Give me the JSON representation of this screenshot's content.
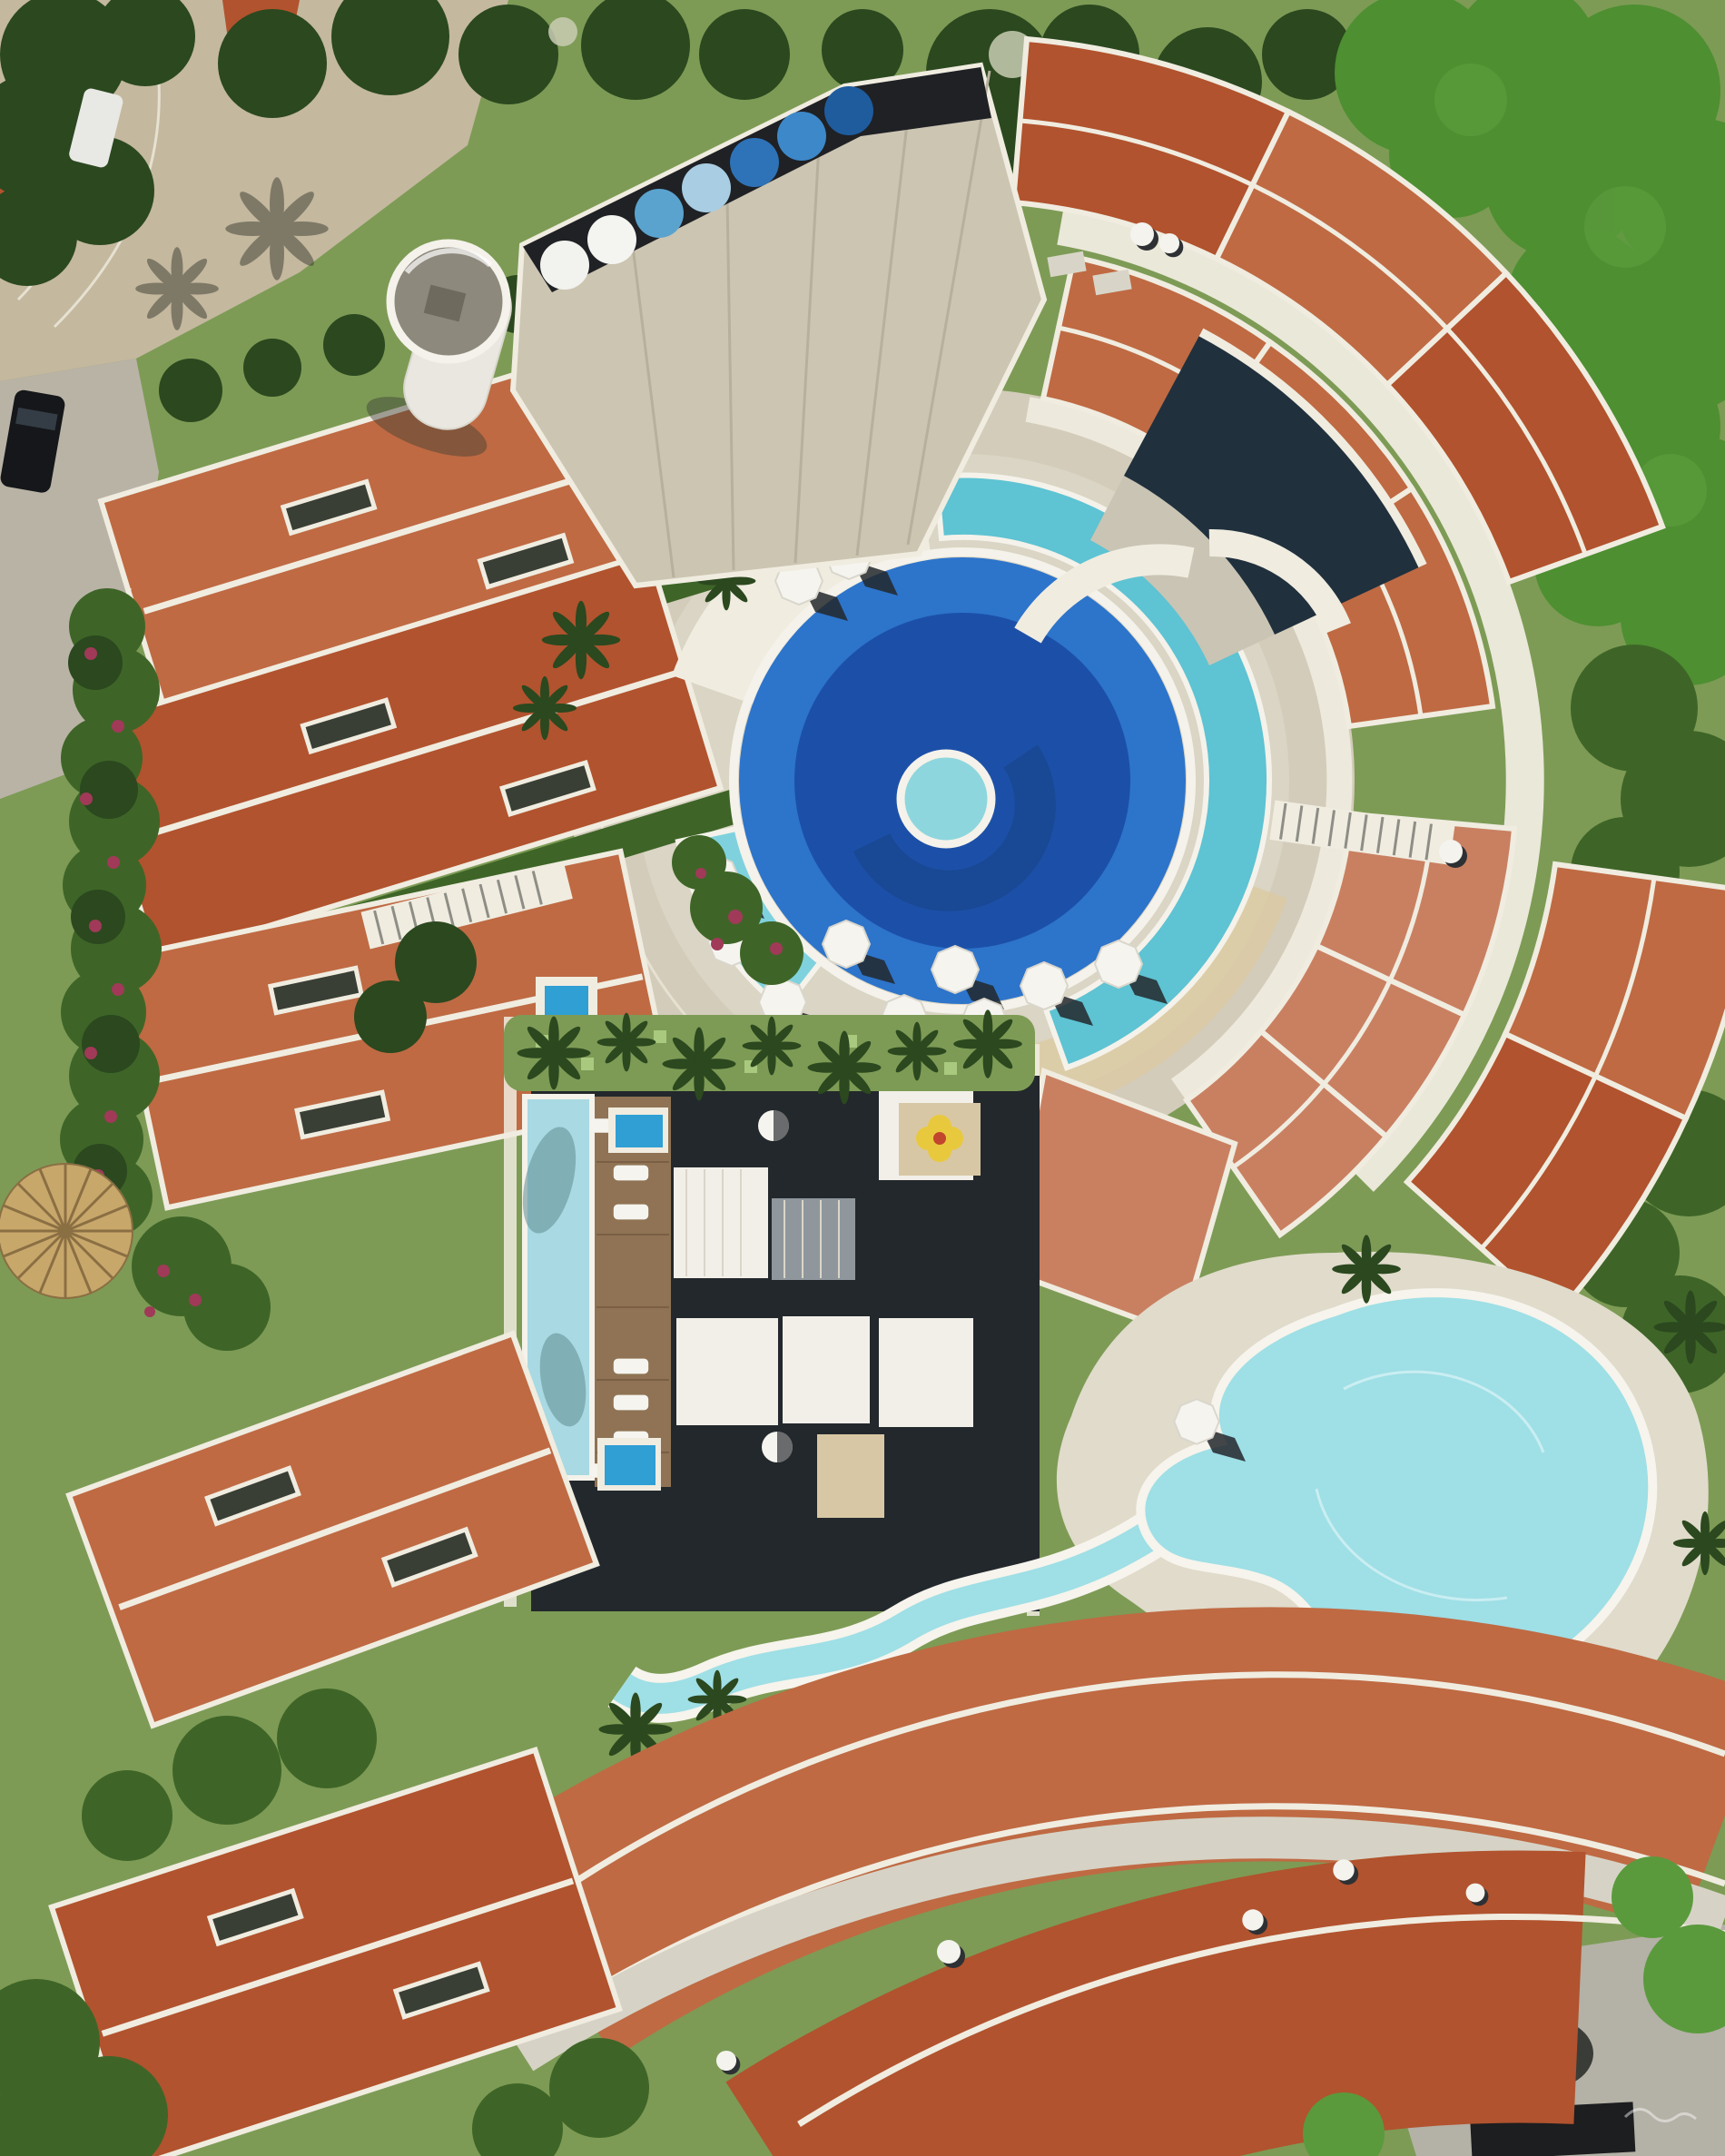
{
  "scene": {
    "type": "aerial-drone-photograph",
    "description": "Top-down aerial view of a circular tropical resort condominium: red clay tile roof buildings arranged in arcs around a central round pool plaza, a freeform lagoon pool, private villas with plunge pools, gardens, palms and access roads",
    "time_of_day": "sunny midday, hard shadows"
  },
  "palette": {
    "grass": "#7d9b55",
    "grass_light": "#a9c97f",
    "tree_dark": "#2b481f",
    "tree_mid": "#3e6527",
    "tree_bright": "#5a9a3c",
    "hedge_bright": "#4e8f31",
    "roof": "#bf6a43",
    "roof_deep": "#b1532e",
    "roof_pale": "#c98061",
    "skylight": "#3a3f35",
    "eave_white": "#f0ece0",
    "walkway": "#d6d3c6",
    "paving": "#d3ccba",
    "paving_light": "#e0dbcb",
    "sand": "#dcc9a0",
    "road": "#c4b89f",
    "road_gray": "#b9b3a6",
    "pool_mid": "#2d74cb",
    "pool_dark": "#1c50a8",
    "pool_navy": "#163f80",
    "lane": "#5ec3d3",
    "lane_light": "#7fd2dd",
    "island": "#8ed6dd",
    "pool_rim": "#f4f2ea",
    "lagoon": "#9fdfe6",
    "lagoon_rim": "#f6f4ec",
    "plunge": "#2f9fd4",
    "lap_pool": "#a9d9e2",
    "lap_shadow": "#5e8d92",
    "deck_wood": "#8f7354",
    "clubhouse_roof": "#ccc5b2",
    "strip_dark": "#1f2125",
    "rooftop_pool": "#20303d",
    "deck_gray": "#cac4b4",
    "villa_white": "#f1efe8",
    "pergola_gray": "#8f979c",
    "patio_beige": "#d8c7a4",
    "courtyard_dark": "#23282c",
    "tower_white": "#e9e7e0",
    "tower_top": "#8d897c",
    "tower_detail": "#6e6a5e",
    "umbrella_white": "#f5f4ef",
    "umbrella_shadow": "#23272b",
    "straw": "#c8a76b",
    "straw_rib": "#8a6f43",
    "flower_yellow": "#e8c93e",
    "flower_center": "#c2452e",
    "bougainvillea": "#a03a58",
    "car_dark": "#15171a",
    "car_glass": "#3c4750",
    "car_white": "#e8e8e4",
    "stone_patio": "#b4b1a6",
    "grill_dark": "#1c1e20",
    "boulder": "#3a3c38",
    "dish_white": "#f4f3ee",
    "dish_shadow": "#2e3134"
  },
  "umbrella_row": {
    "count": 7,
    "location": "rooftop edge of curved clubhouse building",
    "colors": [
      "#f2f2ee",
      "#f4f4f0",
      "#5aa3cf",
      "#a9cde2",
      "#2e73b8",
      "#3c88c9",
      "#1e5c9e"
    ]
  },
  "features": {
    "central_pool": {
      "label": "circular main pool",
      "rings": [
        "white rim",
        "medium blue band",
        "dark blue center",
        "turquoise swim-lane arc",
        "round island with aqua water"
      ]
    },
    "pool_umbrellas": {
      "count": 11,
      "color": "white",
      "shadow": "hard dark"
    },
    "lagoon_pool": {
      "label": "freeform turquoise lagoon pool with long winding arm"
    },
    "clubhouse": {
      "label": "fan-shaped building with corrugated light roof"
    },
    "water_tower": {
      "label": "white cylindrical water tower"
    },
    "villas": {
      "label": "central villa block with white roofs, pergolas, plunge pools, spa tubs"
    },
    "lap_pool": {
      "label": "narrow rectangular lap pool beside wooden deck with loungers"
    },
    "loungers": {
      "count": 7
    },
    "roof_arcs": {
      "label": "red tile roof buildings arranged in concentric arcs",
      "approx_buildings": 18
    },
    "thatch_umbrella": {
      "label": "straw parasol at west garden"
    },
    "roads": {
      "label": "sand-colored access roads, west side"
    },
    "cars": {
      "count": 2
    },
    "satellite_dishes": {
      "count": 7
    },
    "yellow_parasol": {
      "label": "four-petal yellow parasol on villa patio"
    },
    "gardens": {
      "label": "tropical trees, palm bursts, bougainvillea hedges"
    }
  }
}
